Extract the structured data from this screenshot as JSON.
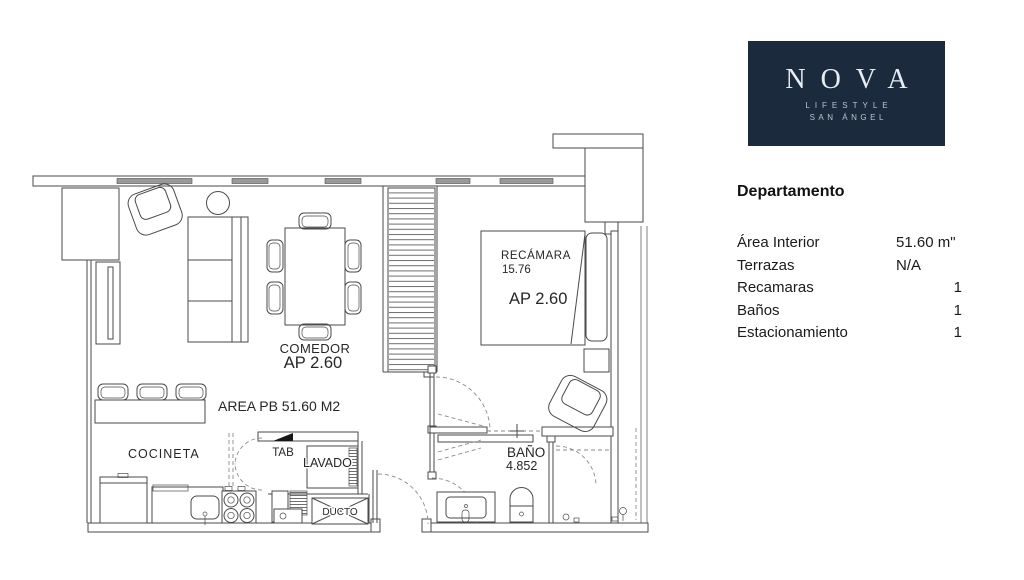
{
  "logo": {
    "bg": "#1c2a3e",
    "title": "NOVA",
    "subtitle1": "LIFESTYLE",
    "subtitle2": "SAN ÁNGEL"
  },
  "panel": {
    "heading": "Departamento",
    "rows": [
      {
        "label": "Área Interior",
        "value": "51.60 m\""
      },
      {
        "label": "Terrazas",
        "value": "N/A"
      },
      {
        "label": "Recamaras",
        "value": "1"
      },
      {
        "label": "Baños",
        "value": "1"
      },
      {
        "label": "Estacionamiento",
        "value": "1"
      }
    ]
  },
  "plan": {
    "line_color": "#4a4a4a",
    "text_color": "#262626",
    "labels": {
      "bedroom": "RECÁMARA",
      "bedroom_area": "15.76",
      "bedroom_height": "AP 2.60",
      "dining": "COMEDOR",
      "dining_height": "AP 2.60",
      "floor_area": "AREA PB 51.60 M2",
      "kitchen": "COCINETA",
      "tab": "TAB",
      "laundry": "LAVADO",
      "duct": "DUCTO",
      "bath": "BAÑO",
      "bath_area": "4.852"
    }
  }
}
